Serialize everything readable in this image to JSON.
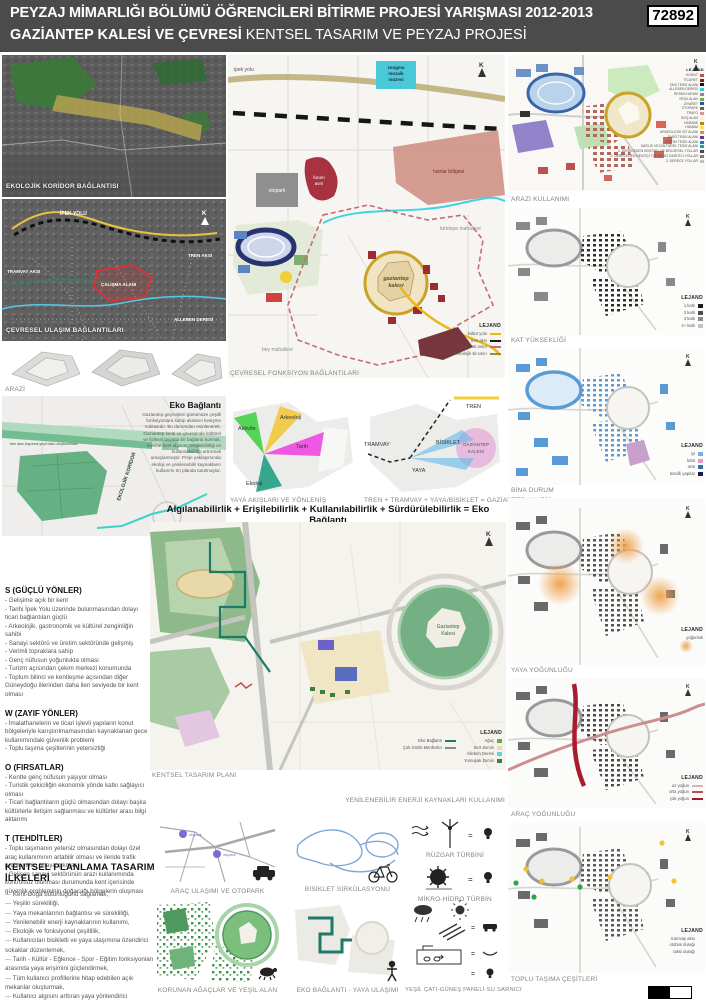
{
  "header": {
    "title_line1": "PEYZAJ MİMARLIĞI BÖLÜMÜ ÖĞRENCİLERİ BİTİRME PROJESİ YARIŞMASI 2012-2013",
    "entry_number": "72892",
    "title_line2_bold": "GAZİANTEP KALESİ VE ÇEVRESİ",
    "title_line2_rest": " KENTSEL TASARIM VE PEYZAJ PROJESİ"
  },
  "left": {
    "ekolojik_koridor_caption": "EKOLOJİK KORİDOR BAĞLANTISI",
    "cevresel_ulasim": {
      "caption": "ÇEVRESEL ULAŞIM BAĞLANTILARI",
      "labels": {
        "ipek_yolu": "İPEK YOLU",
        "tren_aksi": "TREN AKSI",
        "tramvay_aksi": "TRAMVAY AKSI",
        "calisma_alani": "ÇALIŞMA ALANI",
        "alleben_deresi": "ALLEBEN DERESİ",
        "north": "K"
      }
    },
    "arazi_caption": "ARAZİ",
    "eko_baglanti": {
      "title": "Eko Bağlantı",
      "paragraph": "Gaziantep geçmişten günümüze çeşitli fonksiyonlara sahip aksların kesişme noktasıdır. Bu durumdan esinlenerek, Gaziantep kenti ve çevresinde kültürel ve fiziksel boyutta bir bağlantı kurmak; mevcut kent algısını, erişilebilirliği ve kullanılabilirliği arttırmak amaçlanmıştır. Proje yaklaşımında ekoloji ve yenilenebilir kaynakların kullanımı ön planda tutulmuştur.",
      "koridor_label": "EKOLOJİK KORİDOR",
      "kale_label": "Gaziantep Kalesi",
      "yesil_label": "tren aksı boyunca yeşil doku oluşturulması"
    },
    "swot": {
      "s_title": "S  (GÜÇLÜ YÖNLER)",
      "s_items": [
        "- Gelişime açık bir kent",
        "- Tarihi İpek Yolu üzerinde bulunmasından dolayı ticari bağlantıları güçlü",
        "- Arkeolojik, gastronomik ve kültürel zenginliğin sahibi",
        "- Sanayi sektörü ve üretim sektöründe gelişmiş",
        "- Verimli topraklara sahip",
        "- Genç nüfusun yoğunlukta olması",
        "- Turizm açısından çekim merkezi konumunda",
        "- Toplum bilinci ve kentleşme açısından diğer Güneydoğu illerinden daha ileri seviyede bir kent olması"
      ],
      "w_title": "W  (ZAYIF YÖNLER)",
      "w_items": [
        "- İmalathanelerin ve ticari işlevli yapıların konut bölgeleriyle karıştırılmamasından kaynaklanan gece kullanımındaki güvenlik problemi",
        "- Toplu taşıma çeşitlerinin yetersizliği"
      ],
      "o_title": "O  (FIRSATLAR)",
      "o_items": [
        "- Kentte genç nüfusun yaşıyor olması",
        "- Turistik çekiciliğin ekonomik yönde katkı sağlayıcı olması",
        "- Ticari bağlantıların güçlü olmasından dolayı başka kültürlerle iletişim sağlanması ve kültürler arası bilgi aktarımı"
      ],
      "t_title": "T  (TEHDİTLER)",
      "t_items": [
        "- Toplu taşımanın yetersiz olmasından dolayı özel araç kullanımının artabilir olması ve ileride trafik probleminin ortaya çıkması",
        "- Gelişen sanayi sektörünün arazi kullanımında kontrolsüz olunması durumunda kent içerisinde güvenlik probleminin doğacağı bölgelerin oluşması"
      ]
    },
    "principles": {
      "title": "KENTSEL PLANLAMA TASARIM İLKELERİ",
      "items": [
        "Kent-Doğa bütünlüğünü sağlamak,",
        "Yeşilin sürekliliği,",
        "Yaya mekanlarının bağlantısı ve sürekliliği,",
        "Yenilenebilir enerji kaynaklarının kullanımı,",
        "Ekolojik ve fonksiyonel çeşitlilik,",
        "Kullanıcıları bisikletli ve yaya ulaşımına özendirici sokaklar düzenlemek,",
        "Tarih - Kültür - Eğlence - Spor - Eğitim fonksiyonları arasında yaya erişimini güçlendirmek,",
        "Tüm kullanıcı profillerine hitap edebilen açık mekanlar oluşturmak,",
        "Kullanıcı algısını arttıran yaya yönlendirici çözümler,",
        "Kent algısını arttıracak vista noktaları oluşturmak,",
        "Kültürel ve Fiziksel Çevreye uyumluluğu sağlamak."
      ]
    }
  },
  "center": {
    "fonksiyon_map": {
      "caption": "ÇEVRESEL FONKSİYON BAĞLANTILARI",
      "labels": {
        "ipek_yolu": "ipek yolu",
        "zeugma_1": "zeugma",
        "zeugma_2": "mozaik",
        "zeugma_3": "müzesi",
        "otopark": "otopark",
        "forum_1": "forum",
        "forum_2": "avm",
        "hanlar": "hanlar bölgesi",
        "kale_1": "gaziantep",
        "kale_2": "kalesi",
        "turktepe": "türktepe mahallesi",
        "bey": "bey mahallesi",
        "north": "K"
      },
      "legend": {
        "title": "LEJAND",
        "items": [
          {
            "label": "kültür yolu",
            "color": "#e8b820"
          },
          {
            "label": "tren aksı",
            "color": "#1a1a1a"
          },
          {
            "label": "kentsel sit sınırı",
            "color": "#c76b74"
          },
          {
            "label": "arkeolojik sit sınırı",
            "color": "#9a8c3f"
          }
        ]
      }
    },
    "yaya_diagram": {
      "caption": "YAYA AKIŞLARI VE YÖNLENİŞ",
      "aktivite": "Aktivite",
      "arkeoloji": "Arkeoloji",
      "tarih": "Tarih",
      "ekoloji": "Ekoloji"
    },
    "aks_diagram": {
      "caption": "TREN + TRAMVAY + YAYA/BİSİKLET = GAZİANTEP KALESİ",
      "tren": "TREN",
      "tramvay": "TRAMVAY",
      "bisiklet": "BİSİKLET",
      "yaya": "YAYA",
      "kale_1": "GAZİANTEP",
      "kale_2": "KALESİ"
    },
    "headline": "Algılanabilirlik + Erişilebilirlik + Kullanılabilirlik + Sürdürülebilirlik = Eko Bağlantı",
    "master_plan": {
      "caption": "KENTSEL TASARIM PLANI",
      "north": "K",
      "kale_1": "Gaziantep",
      "kale_2": "Kalesi",
      "legend": {
        "title": "LEJAND",
        "left_items": [
          {
            "label": "Eko Bağlantı",
            "color": "#1d7a68"
          },
          {
            "label": "Çok Gözlü Menfezler",
            "color": "#8a8a8a"
          }
        ],
        "right_items": [
          {
            "label": "Ağaç",
            "color": "#6aa84f"
          },
          {
            "label": "Sert Zemin",
            "color": "#e8dcae"
          },
          {
            "label": "Alleben Deresi",
            "color": "#5fd3e0"
          },
          {
            "label": "Yumuşak Zemin",
            "color": "#3e7d44"
          }
        ]
      }
    },
    "renewable_heading": "YENİLENEBİLİR ENERJİ KAYNAKLARI KULLANIMI",
    "bottom": {
      "arac_caption": "ARAÇ ULAŞIMI VE OTOPARK",
      "otopark_label": "otopark",
      "bisiklet_caption": "BİSİKLET SİRKÜLASYONU",
      "ruzgar_caption": "RÜZGAR TÜRBİNİ",
      "hidro_caption": "MİKRO-HİDRO TÜRBİN",
      "korunan_caption": "KORUNAN AĞAÇLAR VE YEŞİL ALAN",
      "eko_yaya_caption": "EKO BAĞLANTI - YAYA ULAŞIMI",
      "cati_caption": "YEŞİL ÇATI-GÜNEŞ PANELİ-SU SARNICI"
    }
  },
  "right": {
    "maps": [
      {
        "caption": "ARAZİ KULLANIMI",
        "north": "K",
        "legend_title": "LEJAND",
        "legend": [
          {
            "label": "KONUT",
            "color": "#c0504d"
          },
          {
            "label": "TİCARET",
            "color": "#7b1f1f"
          },
          {
            "label": "DİNİ TESİS ALANI",
            "color": "#1a1a1a"
          },
          {
            "label": "ALLEBEN DERESİ",
            "color": "#3fc8dc"
          },
          {
            "label": "RESMİ KURUM",
            "color": "#8a8a8a"
          },
          {
            "label": "YEŞİL ALAN",
            "color": "#70ad47"
          },
          {
            "label": "ZİYARET",
            "color": "#2e54a1"
          },
          {
            "label": "OTOPARK",
            "color": "#666666"
          },
          {
            "label": "TRAFO",
            "color": "#d99694"
          },
          {
            "label": "BOŞ ALAN",
            "color": "#f0efe9"
          },
          {
            "label": "HARABE",
            "color": "#b38600"
          },
          {
            "label": "HAMAM",
            "color": "#ffd966"
          },
          {
            "label": "ARKEOLOJİK SİT ALANI",
            "color": "#c9a227"
          },
          {
            "label": "İDARİ TESİS ALANI",
            "color": "#7030a0"
          },
          {
            "label": "EĞİTİM TESİS ALANI",
            "color": "#2e75b6"
          },
          {
            "label": "SAĞLIK VE KÜLTÜREL TESİS ALANI",
            "color": "#00b0b0"
          },
          {
            "label": "1. DERECEDEN KENTSEL VE BÖLGESEL YOLLAR",
            "color": "#4a4a4a"
          },
          {
            "label": "2. DERECEDEN KENTİÇİ TOPLAYICI DAĞITICI YOLLAR",
            "color": "#7f7f7f"
          },
          {
            "label": "3. DERECE YOLLAR",
            "color": "#bfbfbf"
          }
        ]
      },
      {
        "caption": "KAT YÜKSEKLİĞİ",
        "north": "K",
        "legend_title": "LEJAND",
        "legend": [
          {
            "label": "1 katlı",
            "color": "#1a1a1a"
          },
          {
            "label": "2 katlı",
            "color": "#4d4d4d"
          },
          {
            "label": "3 katlı",
            "color": "#8c8c8c"
          },
          {
            "label": "4+ katlı",
            "color": "#c2c2c2"
          }
        ]
      },
      {
        "caption": "BİNA DURUM",
        "north": "K",
        "legend_title": "LEJAND",
        "legend": [
          {
            "label": "iyi",
            "color": "#79aede"
          },
          {
            "label": "kötü",
            "color": "#e299c0"
          },
          {
            "label": "orta",
            "color": "#2f6db4"
          },
          {
            "label": "tescilli yapılar",
            "color": "#1a1a4e"
          }
        ]
      },
      {
        "caption": "YAYA YOĞUNLUĞU",
        "north": "K",
        "legend_title": "LEJAND",
        "legend": [
          {
            "label": "yoğunluk",
            "color": "#f0a04a"
          }
        ]
      },
      {
        "caption": "ARAÇ YOĞUNLUĞU",
        "north": "K",
        "legend_title": "LEJAND",
        "legend": [
          {
            "label": "az yoğun",
            "color": "#d9b3b3"
          },
          {
            "label": "orta yoğun",
            "color": "#c0504d"
          },
          {
            "label": "çok yoğun",
            "color": "#9e1b2e"
          }
        ]
      },
      {
        "caption": "TOPLU TAŞIMA ÇEŞİTLERİ",
        "north": "K",
        "legend_title": "LEJAND",
        "legend": [
          {
            "label": "tramvay aksı",
            "color": "#333333"
          },
          {
            "label": "otobüs durağı",
            "color": "#f2c230"
          },
          {
            "label": "taksi durağı",
            "color": "#2ea44f"
          }
        ]
      }
    ]
  }
}
